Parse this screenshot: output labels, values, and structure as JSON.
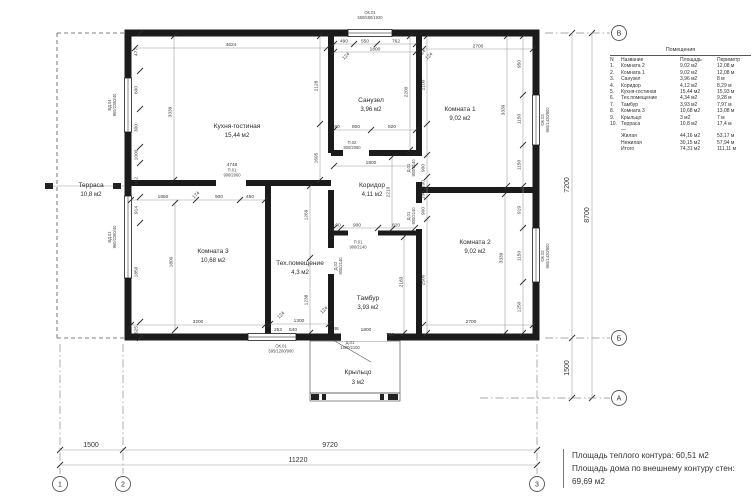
{
  "summary": {
    "line1": "Площадь теплого контура: 60,51 м2",
    "line2": "Площадь дома по внешнему контуру стен: 69,69 м2"
  },
  "legend": {
    "title": "Помещения",
    "headers": [
      "N",
      "Название",
      "Площадь",
      "Периметр"
    ],
    "rows": [
      [
        "1.",
        "Комната 2",
        "9,02 м2",
        "12,08 м"
      ],
      [
        "2.",
        "Комната 1",
        "9,02 м2",
        "12,08 м"
      ],
      [
        "3.",
        "Санузел",
        "3,96 м2",
        "8 м"
      ],
      [
        "4.",
        "Коридор",
        "4,12 м2",
        "8,29 м"
      ],
      [
        "5.",
        "Кухня-гостиная",
        "15,44 м2",
        "15,93 м"
      ],
      [
        "6.",
        "Тех.помещение",
        "4,34 м2",
        "9,28 м"
      ],
      [
        "7.",
        "Тамбур",
        "3,93 м2",
        "7,97 м"
      ],
      [
        "8.",
        "Комната 3",
        "10,68 м2",
        "13,08 м"
      ],
      [
        "9.",
        "Крыльцо",
        "3 м2",
        "7 м"
      ],
      [
        "10.",
        "Терраса",
        "10,8 м2",
        "17,4 м"
      ]
    ],
    "separator": "—",
    "totals": [
      [
        "",
        "Жилая",
        "44,16 м2",
        "53,17 м"
      ],
      [
        "",
        "Нежилая",
        "30,15 м2",
        "57,94 м"
      ],
      [
        "",
        "Итого",
        "74,31 м2",
        "111,11 м"
      ]
    ]
  },
  "axes": {
    "a1": "1",
    "a2": "2",
    "a3": "3",
    "av": "В",
    "ab": "Б",
    "aa": "А"
  },
  "rooms": {
    "kitchen": {
      "name": "Кухня-гостиная",
      "area": "15,44 м2"
    },
    "bath": {
      "name": "Санузел",
      "area": "3,96 м2"
    },
    "room1": {
      "name": "Комната 1",
      "area": "9,02 м2"
    },
    "corridor": {
      "name": "Коридор",
      "area": "4,11 м2"
    },
    "room2": {
      "name": "Комната 2",
      "area": "9,02 м2"
    },
    "room3": {
      "name": "Комната 3",
      "area": "10,68 м2"
    },
    "tech": {
      "name": "Тех.помещение",
      "area": "4,3 м2"
    },
    "tambour": {
      "name": "Тамбур",
      "area": "3,93 м2"
    },
    "terrace": {
      "name": "Терраса",
      "area": "10,8 м2"
    },
    "porch": {
      "name": "Крыльцо",
      "area": "3 м2"
    }
  },
  "openings": {
    "ok01": {
      "id": "ОК.01",
      "size": "550/580/1920"
    },
    "okb": {
      "id": "ОК.01",
      "size": "595/1200/900"
    },
    "ok02": {
      "id": "ОК.02",
      "size": "950/1420/900"
    },
    "ok03": {
      "id": "ОК.03",
      "size": "950/1420/900"
    },
    "vd04": {
      "id": "ВД.04",
      "size": "960/2280/40"
    },
    "vd01": {
      "id": "ВД.01",
      "size": "960/2280/40"
    },
    "p01": {
      "id": "П.01",
      "size": "900/2060"
    },
    "p02": {
      "id": "П.02",
      "size": "800/2060"
    },
    "p03": {
      "id": "П.01",
      "size": "900/2140"
    },
    "d01": {
      "id": "Д.01",
      "size": "900/2140"
    },
    "d02": {
      "id": "Д.02",
      "size": "800/2140"
    },
    "entry": {
      "id": "Д.01",
      "size": "1600/2100"
    }
  },
  "dims": {
    "b1500": "1500",
    "b9720": "9720",
    "b11220": "11220",
    "r7200": "7200",
    "r8700": "8700",
    "r1500": "1500",
    "kw": "4624",
    "kh": "3339",
    "kr1": "2128",
    "kr2": "1695",
    "kdoor": "4748",
    "l1": "477",
    "l2": "600",
    "l3": "300",
    "l4": "1000",
    "l5": "162",
    "l6": "914",
    "l7": "1850",
    "l8": "625",
    "st1": "490",
    "st2": "550",
    "st3": "762",
    "st4": "1800",
    "sb1": "80",
    "sb2": "800",
    "sb3": "920",
    "sh": "2200",
    "r1w": "2700",
    "r1h": "3339",
    "r1l": "2100",
    "r1c1": "950",
    "r1c2": "1150",
    "r1c3": "1150",
    "cw": "1800",
    "ch": "2210",
    "cb1": "90",
    "cb2": "900",
    "cb3": "820",
    "m1": "900",
    "m2": "100",
    "m3": "100",
    "m4": "900",
    "m5": "2500",
    "r2w": "2700",
    "r2h": "3339",
    "r2c1": "919",
    "r2c2": "1150",
    "r2c3": "1250",
    "r3t1": "1850",
    "r3t2": "174",
    "r3t3": "900",
    "r3t4": "450",
    "r3h": "1800",
    "r3w": "3200",
    "te1": "1269",
    "te2": "1238",
    "tew": "1300",
    "teb1": "252",
    "teb2": "540",
    "tah": "2183",
    "taw": "1800",
    "ta1": "46",
    "ta2": "762",
    "t124": "124"
  }
}
